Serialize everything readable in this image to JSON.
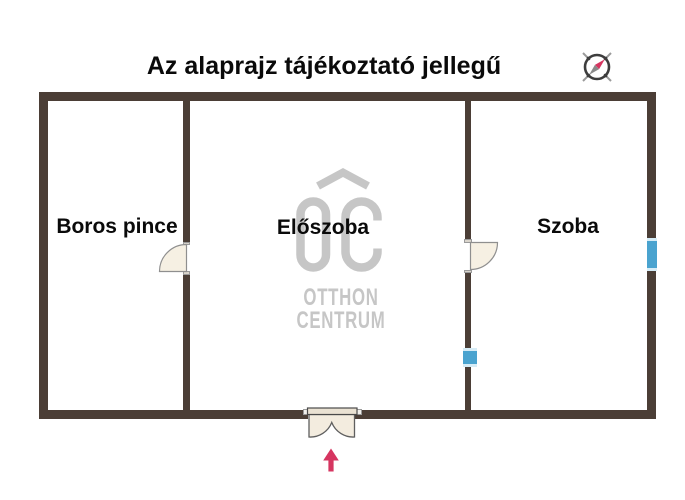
{
  "title": "Az alaprajz tájékoztató jellegű",
  "rooms": [
    {
      "name": "Boros pince"
    },
    {
      "name": "Előszoba"
    },
    {
      "name": "Szoba"
    }
  ],
  "watermark": {
    "brand_abbr": "OC",
    "line1": "OTTHON",
    "line2": "CENTRUM"
  },
  "icons": {
    "compass": "compass-icon",
    "entrance_arrow": "entrance-arrow-icon",
    "doors": [
      "door-swing-boros-pince",
      "door-swing-szoba",
      "entrance-double-door"
    ]
  },
  "colors": {
    "wall": "#4B3E36",
    "window_blue": "#4AA3CF",
    "window_light": "#D6ECF6",
    "arrow_red": "#D63560",
    "logo_gray": "#C6C6C6",
    "door_fill": "#F6F0E3",
    "door_stroke": "#8F8F8F",
    "title_color": "#0A0A0A"
  }
}
